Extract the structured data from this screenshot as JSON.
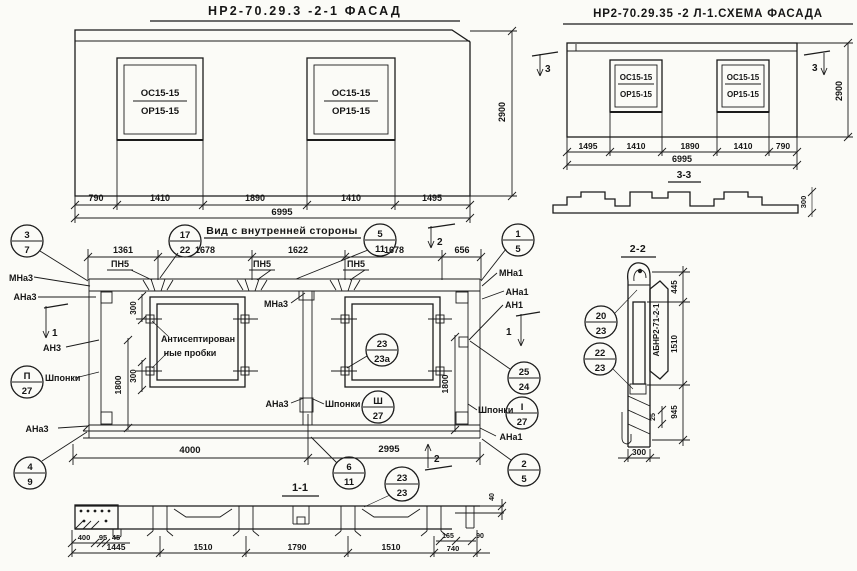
{
  "facade_left": {
    "title": "НР2-70.29.3 -2-1 ФАСАД",
    "win_top": "ОС15-15",
    "win_bot": "ОР15-15",
    "dims": [
      "790",
      "1410",
      "1890",
      "1410",
      "1495"
    ],
    "total": "6995",
    "height": "2900"
  },
  "facade_right": {
    "title": "НР2-70.29.35 -2 Л-1.СХЕМА ФАСАДА",
    "win_top": "ОС15-15",
    "win_bot": "ОР15-15",
    "dims": [
      "1495",
      "1410",
      "1890",
      "1410",
      "790"
    ],
    "total": "6995",
    "height": "2900",
    "cut_mark": "3",
    "section_title": "3-3",
    "profile_dim": "300"
  },
  "inner_view": {
    "title": "Вид с внутренней стороны",
    "top_dims": [
      "1361",
      "1678",
      "1622",
      "1678",
      "656"
    ],
    "pn": "ПН5",
    "mna3": "МНа3",
    "ana3": "АНа3",
    "an3": "АН3",
    "mna1": "МНа1",
    "ana1": "АНа1",
    "an1": "АН1",
    "shponki": "Шпонки",
    "note1": "Антисептирован",
    "note2": "ные пробки",
    "cut1": "1",
    "cut2": "2",
    "dim300": "300",
    "dim1800": "1800",
    "dim4000": "4000",
    "dim2995": "2995",
    "callouts": {
      "c3_7": {
        "t": "3",
        "b": "7"
      },
      "c17_22": {
        "t": "17",
        "b": "22"
      },
      "c5_11": {
        "t": "5",
        "b": "11"
      },
      "c1_5": {
        "t": "1",
        "b": "5"
      },
      "cP27": {
        "t": "П",
        "b": "27"
      },
      "cSh27": {
        "t": "Ш",
        "b": "27"
      },
      "cI27": {
        "t": "I",
        "b": "27"
      },
      "c25_24": {
        "t": "25",
        "b": "24"
      },
      "c23_23a": {
        "t": "23",
        "b": "23а"
      },
      "c4_9": {
        "t": "4",
        "b": "9"
      },
      "c6_11": {
        "t": "6",
        "b": "11"
      },
      "c2_5": {
        "t": "2",
        "b": "5"
      }
    }
  },
  "section_1_1": {
    "title": "1-1",
    "callout": {
      "t": "23",
      "b": "23"
    },
    "sub_dims": [
      "400",
      "95",
      "45"
    ],
    "dims": [
      "1445",
      "1510",
      "1790",
      "1510",
      "740"
    ],
    "small_dims": [
      "165",
      "90"
    ],
    "step_dim": "40"
  },
  "section_2_2": {
    "title": "2-2",
    "stamp": "АБНР2-71-2-1",
    "dims": [
      "445",
      "1510",
      "945"
    ],
    "dim25": "25",
    "dim300": "300",
    "callouts": {
      "c20_23": {
        "t": "20",
        "b": "23"
      },
      "c22_23": {
        "t": "22",
        "b": "23"
      }
    }
  }
}
